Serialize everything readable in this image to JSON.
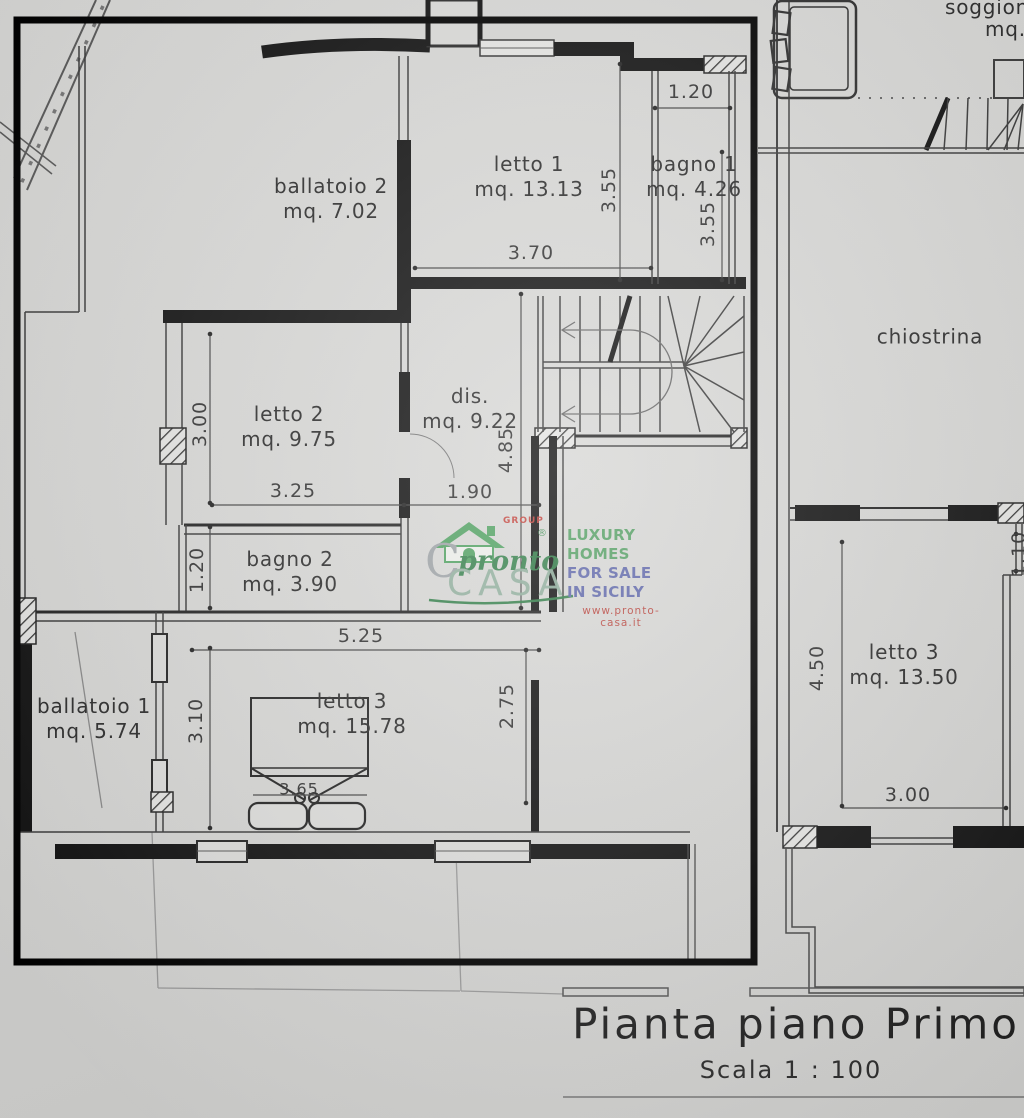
{
  "plan": {
    "title": "Pianta piano Primo",
    "scale": "Scala 1 : 100",
    "labels": {
      "ballatoio2": {
        "name": "ballatoio 2",
        "area": "mq. 7.02"
      },
      "letto1": {
        "name": "letto 1",
        "area": "mq. 13.13"
      },
      "bagno1": {
        "name": "bagno 1",
        "area": "mq. 4.26"
      },
      "letto2": {
        "name": "letto 2",
        "area": "mq. 9.75"
      },
      "dis": {
        "name": "dis.",
        "area": "mq. 9.22"
      },
      "bagno2": {
        "name": "bagno 2",
        "area": "mq. 3.90"
      },
      "ballatoio1": {
        "name": "ballatoio 1",
        "area": "mq. 5.74"
      },
      "letto3": {
        "name": "letto 3",
        "area": "mq. 15.78"
      },
      "soggiorno": {
        "name": "soggiono—",
        "area": "mq. 3"
      },
      "chiostrina": {
        "name": "chiostrina"
      },
      "letto3r": {
        "name": "letto 3",
        "area": "mq. 13.50"
      }
    },
    "dims": {
      "top_bagno1": "1.20",
      "letto1_height": "3.55",
      "bagno1_height": "3.55",
      "letto1_width": "3.70",
      "letto2_height": "3.00",
      "letto2_width": "3.25",
      "dis_width": "1.90",
      "dis_height": "4.85",
      "bagno2_height": "1.20",
      "corridor_width": "5.25",
      "letto3_height": "3.10",
      "letto3_height2": "2.75",
      "bed_width": "3.65",
      "letto3r_height": "4.50",
      "letto3r_width": "3.00",
      "letto3r_step": "1.10"
    }
  },
  "watermark": {
    "group": "GROUP",
    "reg": "®",
    "brand_c": "C",
    "brand_pronto": "pronto",
    "brand_casa": "CASA",
    "tagline1": "LUXURY HOMES",
    "tagline2": "FOR SALE IN SICILY",
    "url": "www.pronto-casa.it",
    "flag_green": "#8fbe98",
    "flag_white": "#f2f2f0",
    "flag_red": "#c6392f"
  }
}
